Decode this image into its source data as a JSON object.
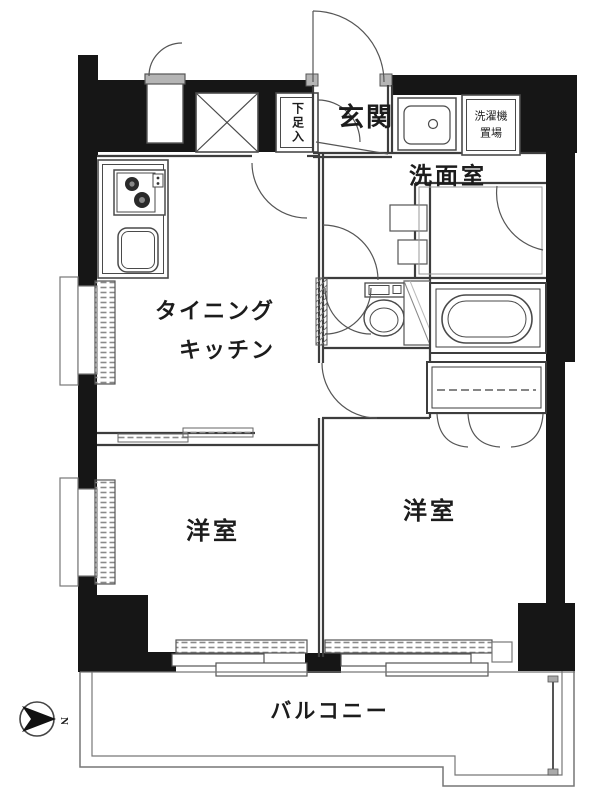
{
  "floorplan": {
    "labels": {
      "entrance": "玄関",
      "shoe_storage": "下足入",
      "washer_storage": "洗濯機\n置場",
      "washroom": "洗面室",
      "dining": "タイニング",
      "kitchen": "キッチン",
      "bedroom_left": "洋室",
      "bedroom_right": "洋室",
      "balcony": "バルコニー"
    },
    "compass": {
      "north_label": "N"
    },
    "colors": {
      "wall": "#161616",
      "line": "#3d3d3d",
      "detail_line": "#555555",
      "hatch": "#8a8a8a",
      "door_leaf": "#b5b5b5",
      "background": "#ffffff"
    }
  }
}
